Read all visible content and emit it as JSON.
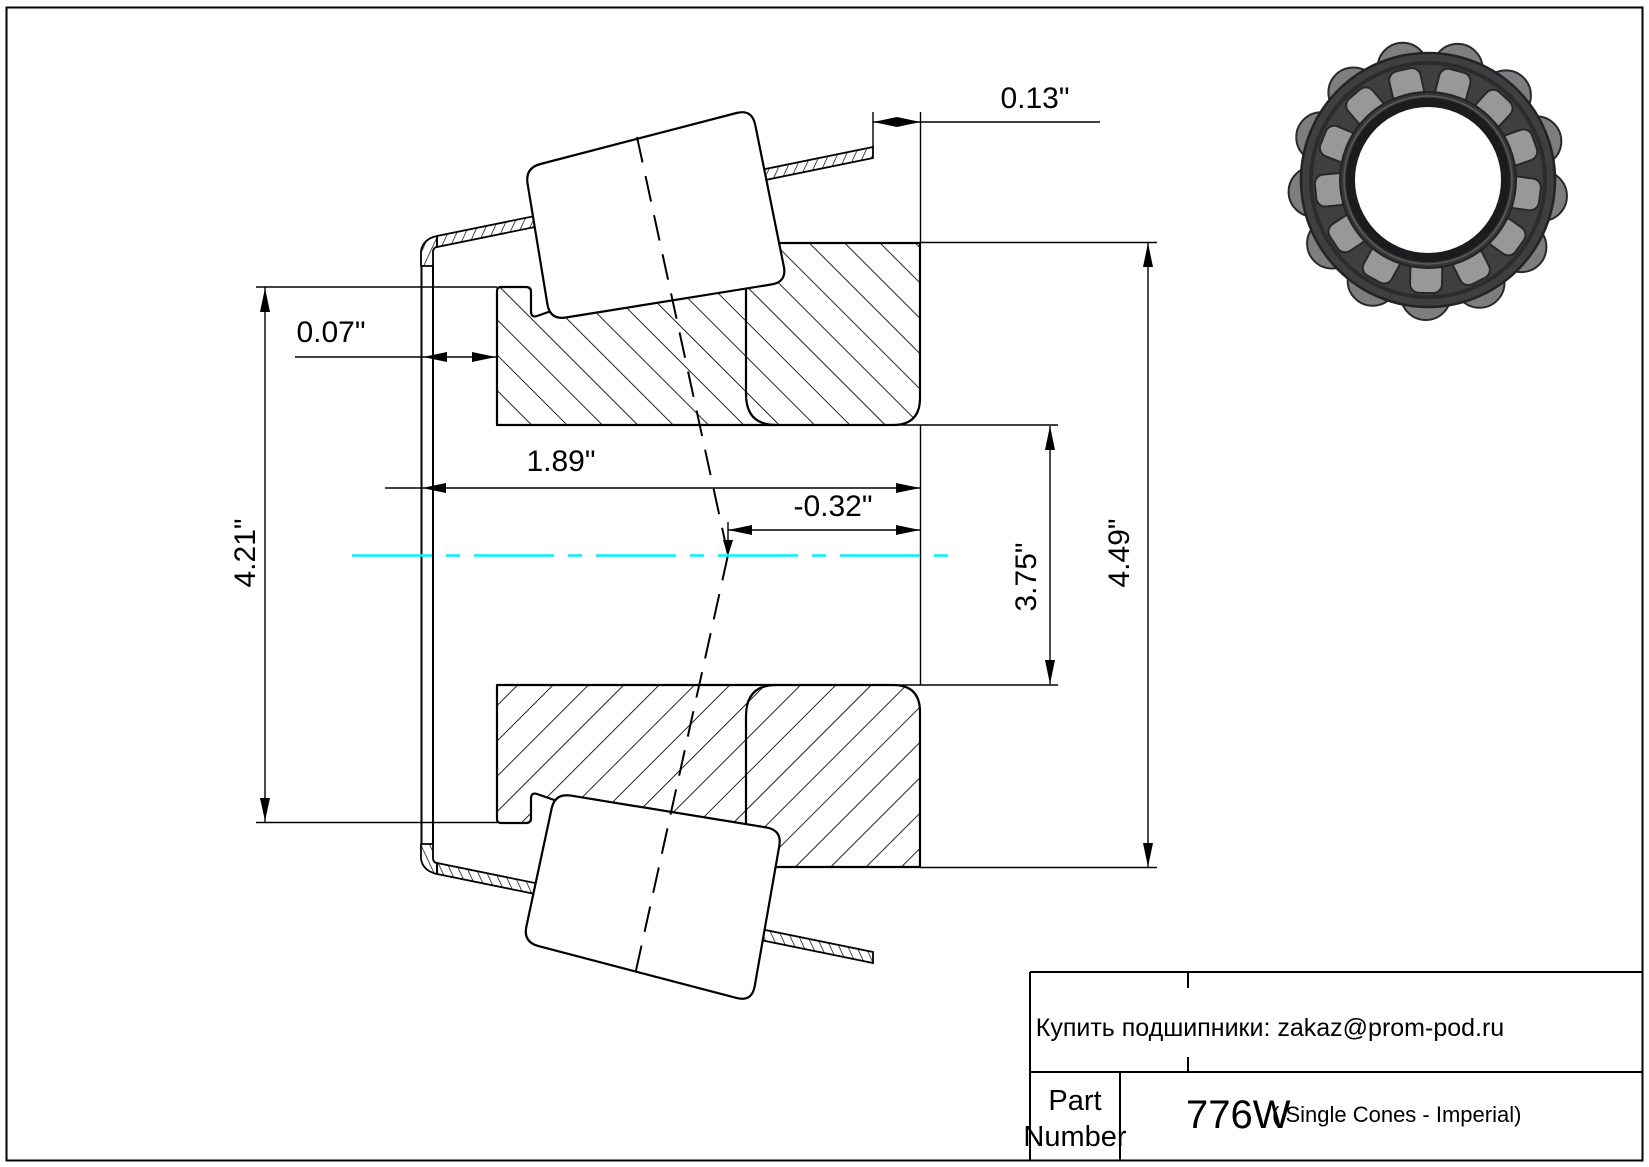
{
  "drawing": {
    "dimensions": {
      "d013": "0.13\"",
      "d007": "0.07\"",
      "d189": "1.89\"",
      "d032": "-0.32\"",
      "d421": "4.21\"",
      "d375": "3.75\"",
      "d449": "4.49\""
    },
    "centerline_color": "#00f2ff",
    "line_color": "#000000"
  },
  "title_block": {
    "vendor_note": "Купить подшипники: zakaz@prom-pod.ru",
    "part_label_line1": "Part",
    "part_label_line2": "Number",
    "part_number": "776W",
    "part_series": "( Single Cones - Imperial)"
  },
  "bearing_photo": {
    "roller_count": 13,
    "cage_color": "#3f3f41",
    "roller_color": "#98989a",
    "bump_color": "#7e7e80",
    "inner_ring_color": "#353537",
    "bore_edge_color": "#1c1c1e"
  }
}
